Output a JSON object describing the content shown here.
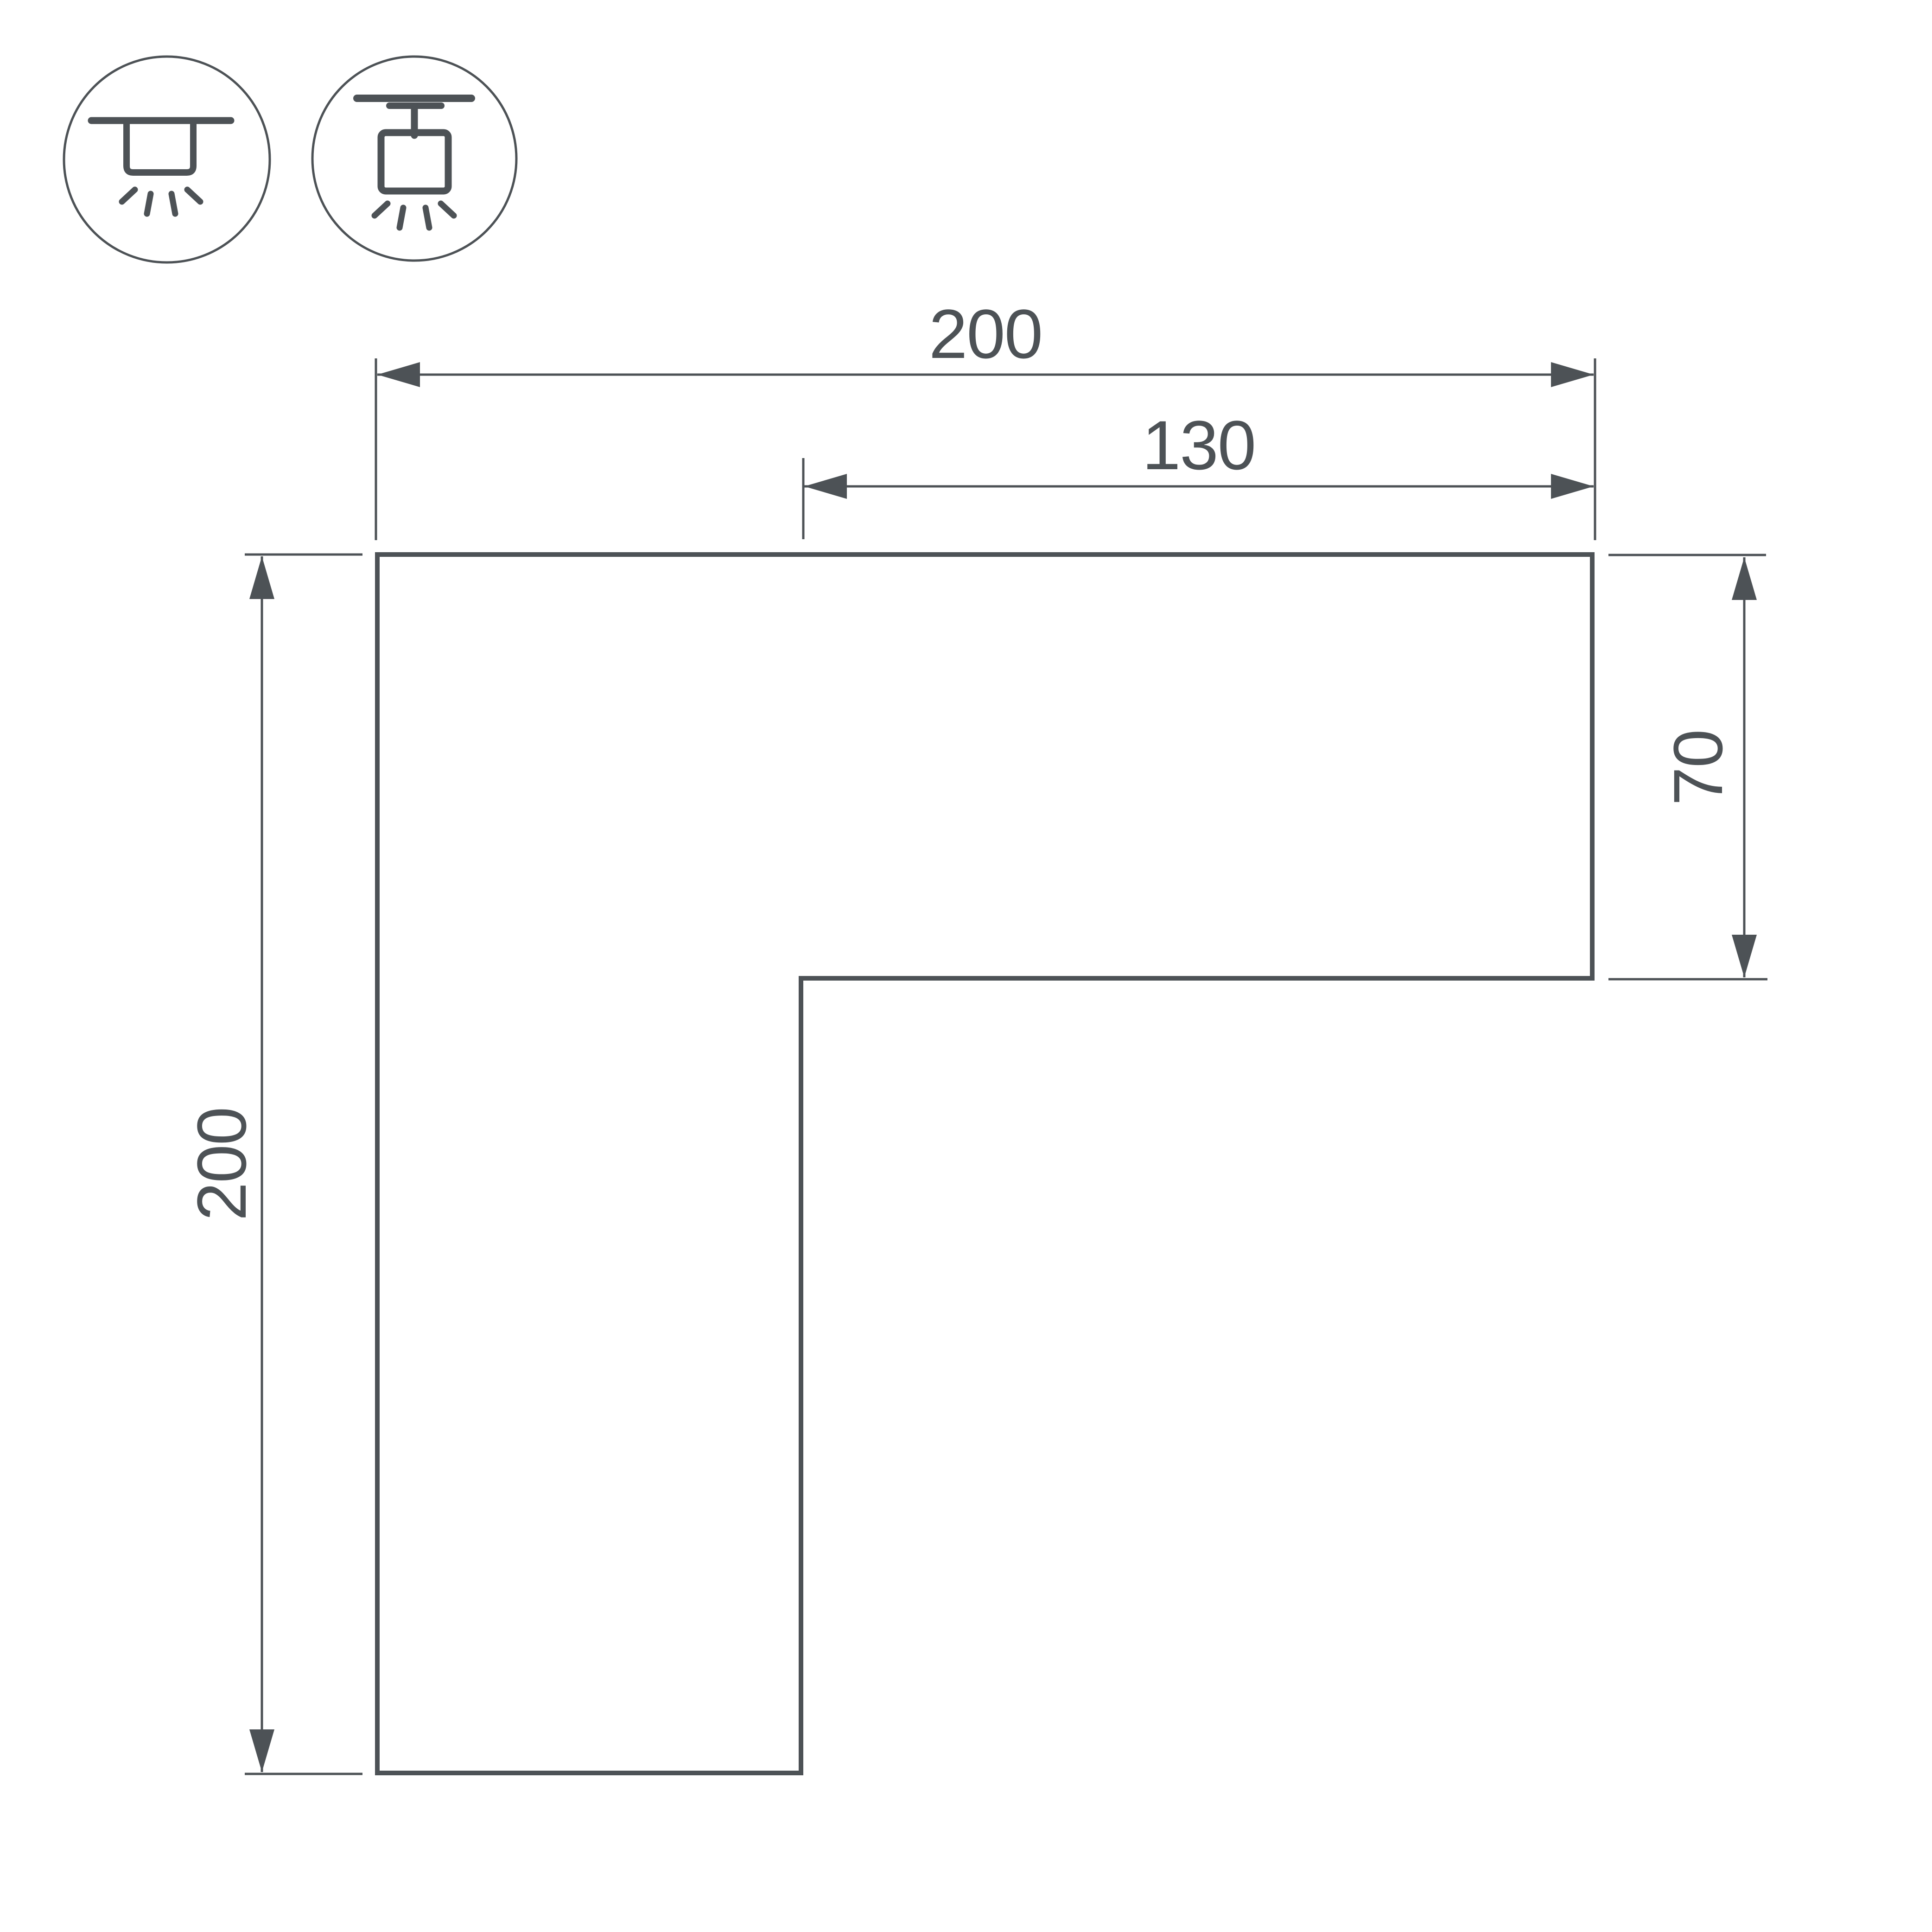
{
  "drawing": {
    "background": "#ffffff",
    "line_color": "#4d5256",
    "labels": {
      "overall_width": "200",
      "inner_width": "130",
      "arm_height": "70",
      "overall_height": "200"
    },
    "icons": [
      {
        "name": "surface-mount-luminaire-icon"
      },
      {
        "name": "track-mount-luminaire-icon"
      }
    ]
  }
}
